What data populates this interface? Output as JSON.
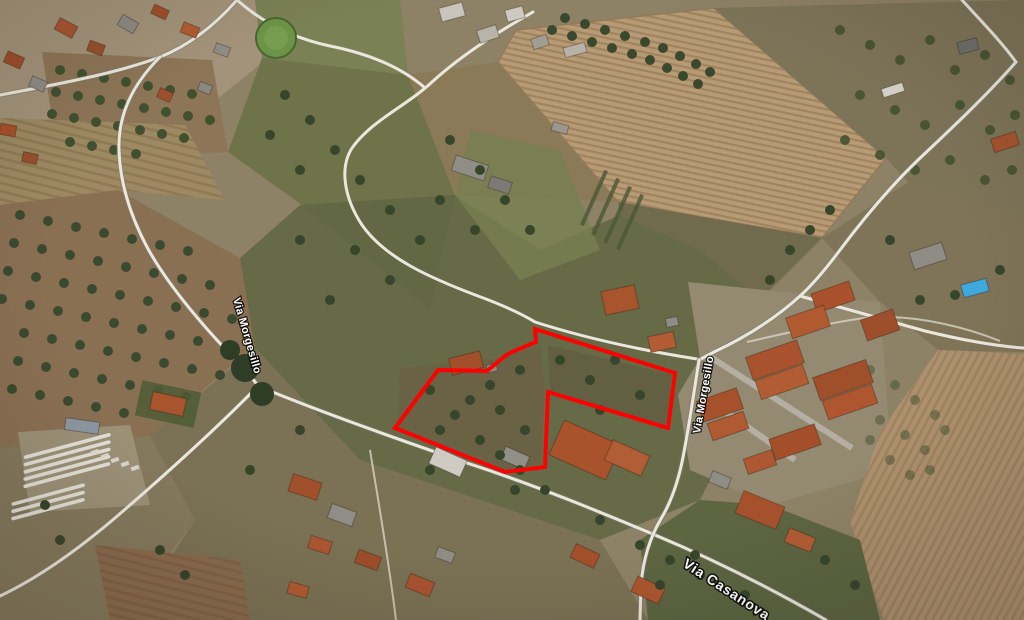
{
  "view": {
    "description": "Aerial satellite photo of a rural/residential area with a red parcel boundary overlay",
    "road_labels": {
      "bottom": "Via Casanova",
      "right": "Via Morgesillo",
      "left": "Via Morgesillo"
    },
    "parcel": {
      "points": "535,329 675,373 668,428 548,392 545,467 505,472 395,428 438,370 487,371 505,356 512,352 536,342",
      "color": "#ff0000"
    },
    "palette": {
      "plowed_field": "#b69b75",
      "scrub_green": "#5f6642",
      "road": "#eae7dc",
      "roof_terracotta": "#a8532c",
      "pool_blue": "#3fa9dd"
    }
  }
}
